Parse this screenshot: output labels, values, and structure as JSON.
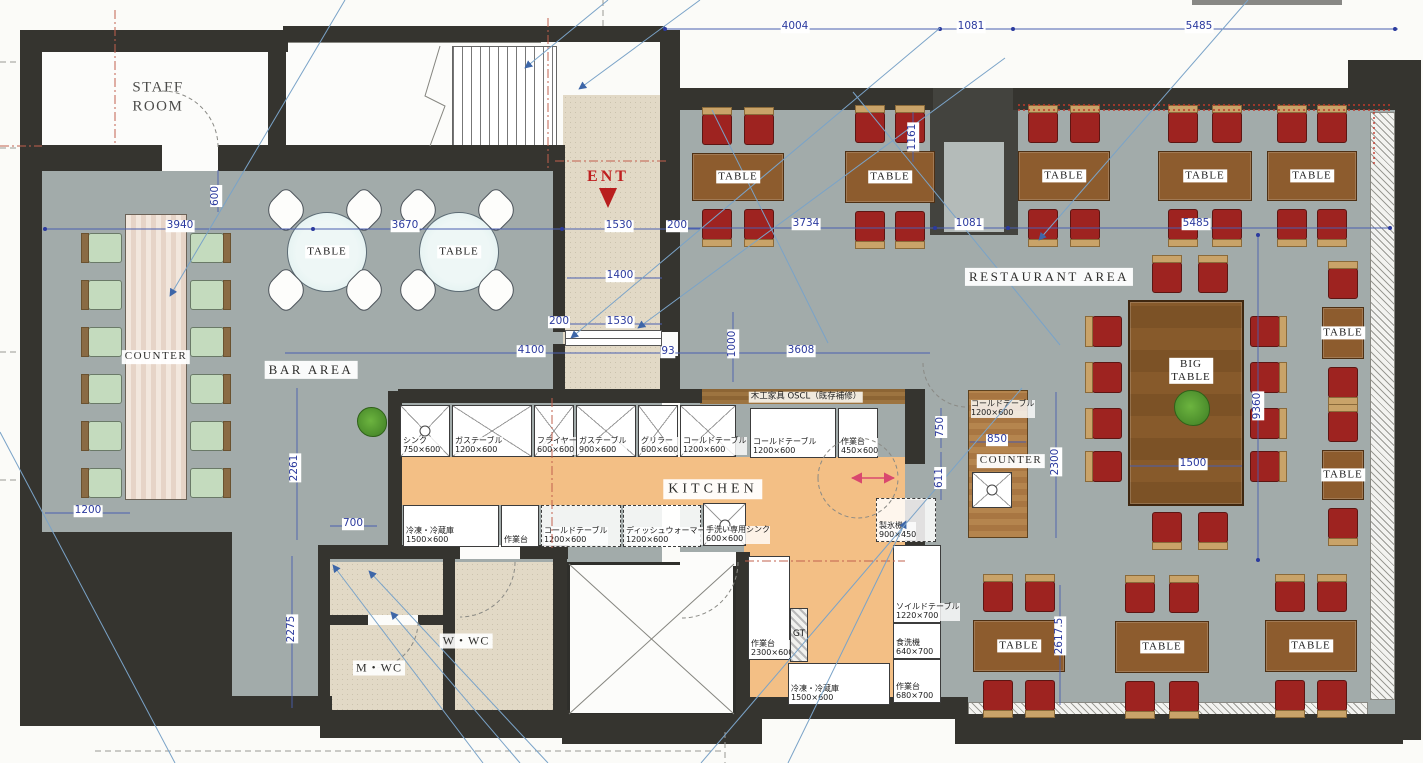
{
  "drawing": {
    "type": "restaurant floor plan",
    "colors": {
      "wall": "#35342f",
      "floor_gray": "#a2abaa",
      "floor_kitchen": "#f3bf85",
      "floor_entry": "#e2d9c6",
      "table_wood": "#8d5c2e",
      "chair_red": "#9e2320",
      "chair_green": "#c4dbbe",
      "bar_counter_wood": "#efe2d8",
      "restaurant_counter_wood": "#b0804a",
      "dimension_blue": "#2b3a9e",
      "accent_red": "#bf1f1f",
      "leader_blue": "#7aa3c8",
      "swing_pink": "#d9486e"
    }
  },
  "labels": {
    "staff_room": "STAFF\nROOM",
    "ent": "ENT",
    "bar_area": "BAR AREA",
    "restaurant_area": "RESTAURANT AREA",
    "kitchen": "KITCHEN",
    "counter": "COUNTER",
    "table": "TABLE",
    "big_table": "BIG\nTABLE",
    "m_wc": "M・WC",
    "w_wc": "W・WC",
    "carpentry_note": "木工家具 OSCL（既存補修）"
  },
  "area_labels": [
    {
      "k": "staff_room",
      "x": 158,
      "y": 97,
      "cls": "lbl-staff"
    },
    {
      "k": "ent",
      "x": 608,
      "y": 177,
      "cls": "lbl-ent"
    },
    {
      "k": "bar_area",
      "x": 311,
      "y": 370,
      "cls": "lbl-area"
    },
    {
      "k": "restaurant_area",
      "x": 1049,
      "y": 277,
      "cls": "lbl-area"
    },
    {
      "k": "kitchen",
      "x": 713,
      "y": 489,
      "cls": "lbl-kitchen"
    },
    {
      "k": "counter",
      "x": 156,
      "y": 357,
      "cls": "lbl-small"
    },
    {
      "k": "counter",
      "x": 1011,
      "y": 461,
      "cls": "lbl-small"
    },
    {
      "k": "m_wc",
      "x": 379,
      "y": 668,
      "cls": "lbl-wc"
    },
    {
      "k": "w_wc",
      "x": 466,
      "y": 641,
      "cls": "lbl-wc"
    },
    {
      "k": "carpentry_note",
      "x": 806,
      "y": 397,
      "cls": "lbl-jnote"
    }
  ],
  "dimensions": [
    {
      "t": "4004",
      "x": 795,
      "y": 27
    },
    {
      "t": "1081",
      "x": 971,
      "y": 27
    },
    {
      "t": "5485",
      "x": 1199,
      "y": 27
    },
    {
      "t": "3940",
      "x": 180,
      "y": 226
    },
    {
      "t": "3670",
      "x": 405,
      "y": 226
    },
    {
      "t": "600",
      "x": 216,
      "y": 196,
      "v": 1
    },
    {
      "t": "1530",
      "x": 619,
      "y": 226
    },
    {
      "t": "200",
      "x": 677,
      "y": 226
    },
    {
      "t": "1400",
      "x": 620,
      "y": 276
    },
    {
      "t": "200",
      "x": 559,
      "y": 322
    },
    {
      "t": "1530",
      "x": 620,
      "y": 322
    },
    {
      "t": "4100",
      "x": 531,
      "y": 351
    },
    {
      "t": "93",
      "x": 668,
      "y": 352
    },
    {
      "t": "1000",
      "x": 733,
      "y": 344,
      "v": 1
    },
    {
      "t": "3608",
      "x": 801,
      "y": 351
    },
    {
      "t": "3734",
      "x": 806,
      "y": 224
    },
    {
      "t": "1081",
      "x": 969,
      "y": 224
    },
    {
      "t": "5485",
      "x": 1196,
      "y": 224
    },
    {
      "t": "1161",
      "x": 913,
      "y": 137,
      "v": 1
    },
    {
      "t": "750",
      "x": 941,
      "y": 427,
      "v": 1
    },
    {
      "t": "611",
      "x": 940,
      "y": 478,
      "v": 1
    },
    {
      "t": "850",
      "x": 997,
      "y": 440
    },
    {
      "t": "2300",
      "x": 1056,
      "y": 462,
      "v": 1
    },
    {
      "t": "2261",
      "x": 295,
      "y": 468,
      "v": 1
    },
    {
      "t": "700",
      "x": 353,
      "y": 524
    },
    {
      "t": "1200",
      "x": 88,
      "y": 511
    },
    {
      "t": "2275",
      "x": 292,
      "y": 629,
      "v": 1
    },
    {
      "t": "2617.5",
      "x": 1060,
      "y": 636,
      "v": 1
    },
    {
      "t": "9360",
      "x": 1258,
      "y": 406,
      "v": 1
    },
    {
      "t": "1500",
      "x": 1193,
      "y": 464
    }
  ],
  "furniture": {
    "dining_tables": [
      {
        "x": 692,
        "y": 153,
        "w": 92,
        "h": 48
      },
      {
        "x": 845,
        "y": 151,
        "w": 90,
        "h": 52
      },
      {
        "x": 1018,
        "y": 151,
        "w": 92,
        "h": 50
      },
      {
        "x": 1158,
        "y": 151,
        "w": 94,
        "h": 50
      },
      {
        "x": 1267,
        "y": 151,
        "w": 90,
        "h": 50
      },
      {
        "x": 973,
        "y": 620,
        "w": 92,
        "h": 52
      },
      {
        "x": 1115,
        "y": 621,
        "w": 94,
        "h": 52
      },
      {
        "x": 1265,
        "y": 620,
        "w": 92,
        "h": 52
      }
    ],
    "side_tables": [
      {
        "x": 1322,
        "y": 307,
        "w": 42,
        "h": 52
      },
      {
        "x": 1322,
        "y": 450,
        "w": 42,
        "h": 50
      }
    ],
    "big_table": {
      "x": 1128,
      "y": 300,
      "w": 116,
      "h": 206,
      "label_x": 1191,
      "label_y": 371,
      "chairs_top": [
        [
          1152,
          262
        ],
        [
          1198,
          262
        ]
      ],
      "chairs_bottom": [
        [
          1152,
          512
        ],
        [
          1198,
          512
        ]
      ],
      "chairs_left": [
        [
          1092,
          316
        ],
        [
          1092,
          362
        ],
        [
          1092,
          408
        ],
        [
          1092,
          451
        ]
      ],
      "chairs_right": [
        [
          1250,
          316
        ],
        [
          1250,
          362
        ],
        [
          1250,
          408
        ],
        [
          1250,
          451
        ]
      ]
    },
    "round_tables": [
      {
        "cx": 327,
        "cy": 252,
        "r": 40
      },
      {
        "cx": 459,
        "cy": 252,
        "r": 40
      }
    ],
    "round_chair_offsets": [
      [
        -58,
        -59
      ],
      [
        20,
        -59
      ],
      [
        -58,
        21
      ],
      [
        20,
        21
      ]
    ],
    "bar_counter": {
      "x": 125,
      "y": 214,
      "w": 62,
      "h": 286,
      "left_chair_x": 88,
      "right_chair_x": 190,
      "chair_ys": [
        233,
        280,
        327,
        374,
        421,
        468
      ]
    },
    "restaurant_counter": {
      "x": 968,
      "y": 390,
      "w": 60,
      "h": 148
    },
    "plants": [
      {
        "cx": 1191,
        "cy": 407,
        "r": 17
      },
      {
        "cx": 371,
        "cy": 421,
        "r": 14
      }
    ]
  },
  "kitchen": {
    "equipment": [
      {
        "n": "シンク",
        "s": "750×600",
        "x": 400,
        "y": 405,
        "w": 50,
        "h": 52,
        "type": "sink"
      },
      {
        "n": "ガステーブル",
        "s": "1200×600",
        "x": 452,
        "y": 405,
        "w": 80,
        "h": 52,
        "type": "x"
      },
      {
        "n": "フライヤー",
        "s": "600×600",
        "x": 534,
        "y": 405,
        "w": 40,
        "h": 52,
        "type": "x"
      },
      {
        "n": "ガステーブル",
        "s": "900×600",
        "x": 576,
        "y": 405,
        "w": 60,
        "h": 52,
        "type": "x"
      },
      {
        "n": "グリラー",
        "s": "600×600",
        "x": 638,
        "y": 405,
        "w": 40,
        "h": 52,
        "type": "x"
      },
      {
        "n": "コールドテーブル",
        "s": "1200×600",
        "x": 680,
        "y": 405,
        "w": 56,
        "h": 52,
        "type": "x"
      },
      {
        "n": "コールドテーブル",
        "s": "1200×600",
        "x": 750,
        "y": 408,
        "w": 86,
        "h": 50,
        "type": "plain"
      },
      {
        "n": "作業台",
        "s": "450×600",
        "x": 838,
        "y": 408,
        "w": 40,
        "h": 50,
        "type": "plain"
      },
      {
        "n": "冷凍・冷蔵庫",
        "s": "1500×600",
        "x": 403,
        "y": 505,
        "w": 96,
        "h": 42,
        "type": "plain"
      },
      {
        "n": "作業台",
        "s": "",
        "x": 501,
        "y": 505,
        "w": 38,
        "h": 42,
        "type": "plain"
      },
      {
        "n": "コールドテーブル",
        "s": "1200×600",
        "x": 541,
        "y": 505,
        "w": 80,
        "h": 42,
        "type": "dashed"
      },
      {
        "n": "ディッシュウォーマー",
        "s": "1200×600",
        "x": 623,
        "y": 505,
        "w": 78,
        "h": 42,
        "type": "dashed"
      },
      {
        "n": "手洗い専用シンク",
        "s": "600×600",
        "x": 703,
        "y": 503,
        "w": 43,
        "h": 43,
        "type": "sink"
      },
      {
        "n": "作業台",
        "s": "2300×600",
        "x": 748,
        "y": 556,
        "w": 42,
        "h": 104,
        "type": "plain"
      },
      {
        "n": "GT",
        "s": "",
        "x": 790,
        "y": 608,
        "w": 18,
        "h": 54,
        "type": "hatch"
      },
      {
        "n": "冷凍・冷蔵庫",
        "s": "1500×600",
        "x": 788,
        "y": 663,
        "w": 102,
        "h": 42,
        "type": "plain"
      },
      {
        "n": "ソイルドテーブル",
        "s": "1220×700",
        "x": 893,
        "y": 545,
        "w": 48,
        "h": 78,
        "type": "plain"
      },
      {
        "n": "食洗機",
        "s": "640×700",
        "x": 893,
        "y": 623,
        "w": 48,
        "h": 36,
        "type": "plain"
      },
      {
        "n": "作業台",
        "s": "680×700",
        "x": 893,
        "y": 659,
        "w": 48,
        "h": 44,
        "type": "plain"
      },
      {
        "n": "製氷機",
        "s": "900×450",
        "x": 876,
        "y": 498,
        "w": 60,
        "h": 44,
        "type": "dashed"
      },
      {
        "n": "コールドテーブル",
        "s": "1200×600",
        "x": 969,
        "y": 393,
        "w": 58,
        "h": 26,
        "type": "labelonly"
      }
    ]
  }
}
